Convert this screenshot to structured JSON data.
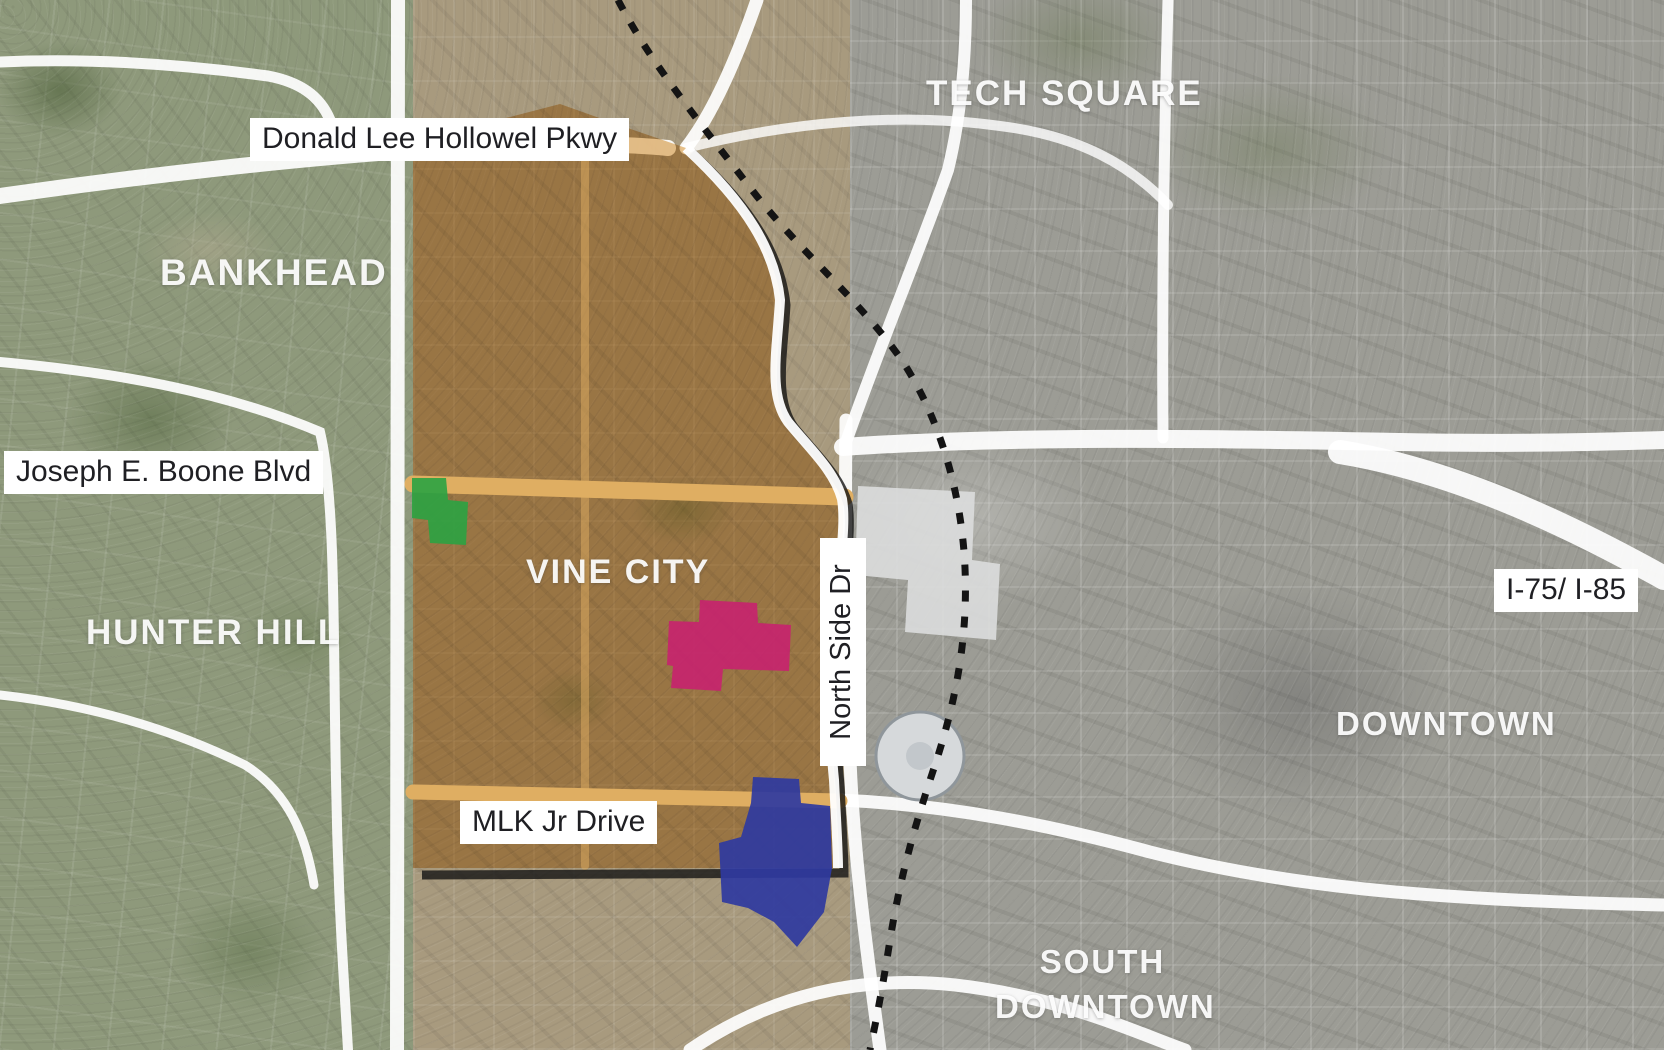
{
  "map": {
    "area_labels": {
      "bankhead": "BANKHEAD",
      "hunter_hill": "HUNTER HILL",
      "vine_city": "VINE CITY",
      "tech_square": "TECH SQUARE",
      "downtown": "DOWNTOWN",
      "south_downtown_line1": "SOUTH",
      "south_downtown_line2": "DOWNTOWN"
    },
    "road_labels": {
      "donald_lee_hollowel": "Donald Lee Hollowel Pkwy",
      "joseph_e_boone": "Joseph E. Boone Blvd",
      "mlk_jr_drive": "MLK Jr Drive",
      "north_side_dr": "North Side Dr",
      "i75_i85": "I-75/ I-85"
    },
    "overlays": {
      "vine_city_fill": "#d89435",
      "green_parcel": "#2ba343",
      "pink_parcel": "#c8206f",
      "blue_parcel": "#2f3aa0",
      "railroad_color": "#141414",
      "boundary_shadow": "#141414"
    }
  }
}
